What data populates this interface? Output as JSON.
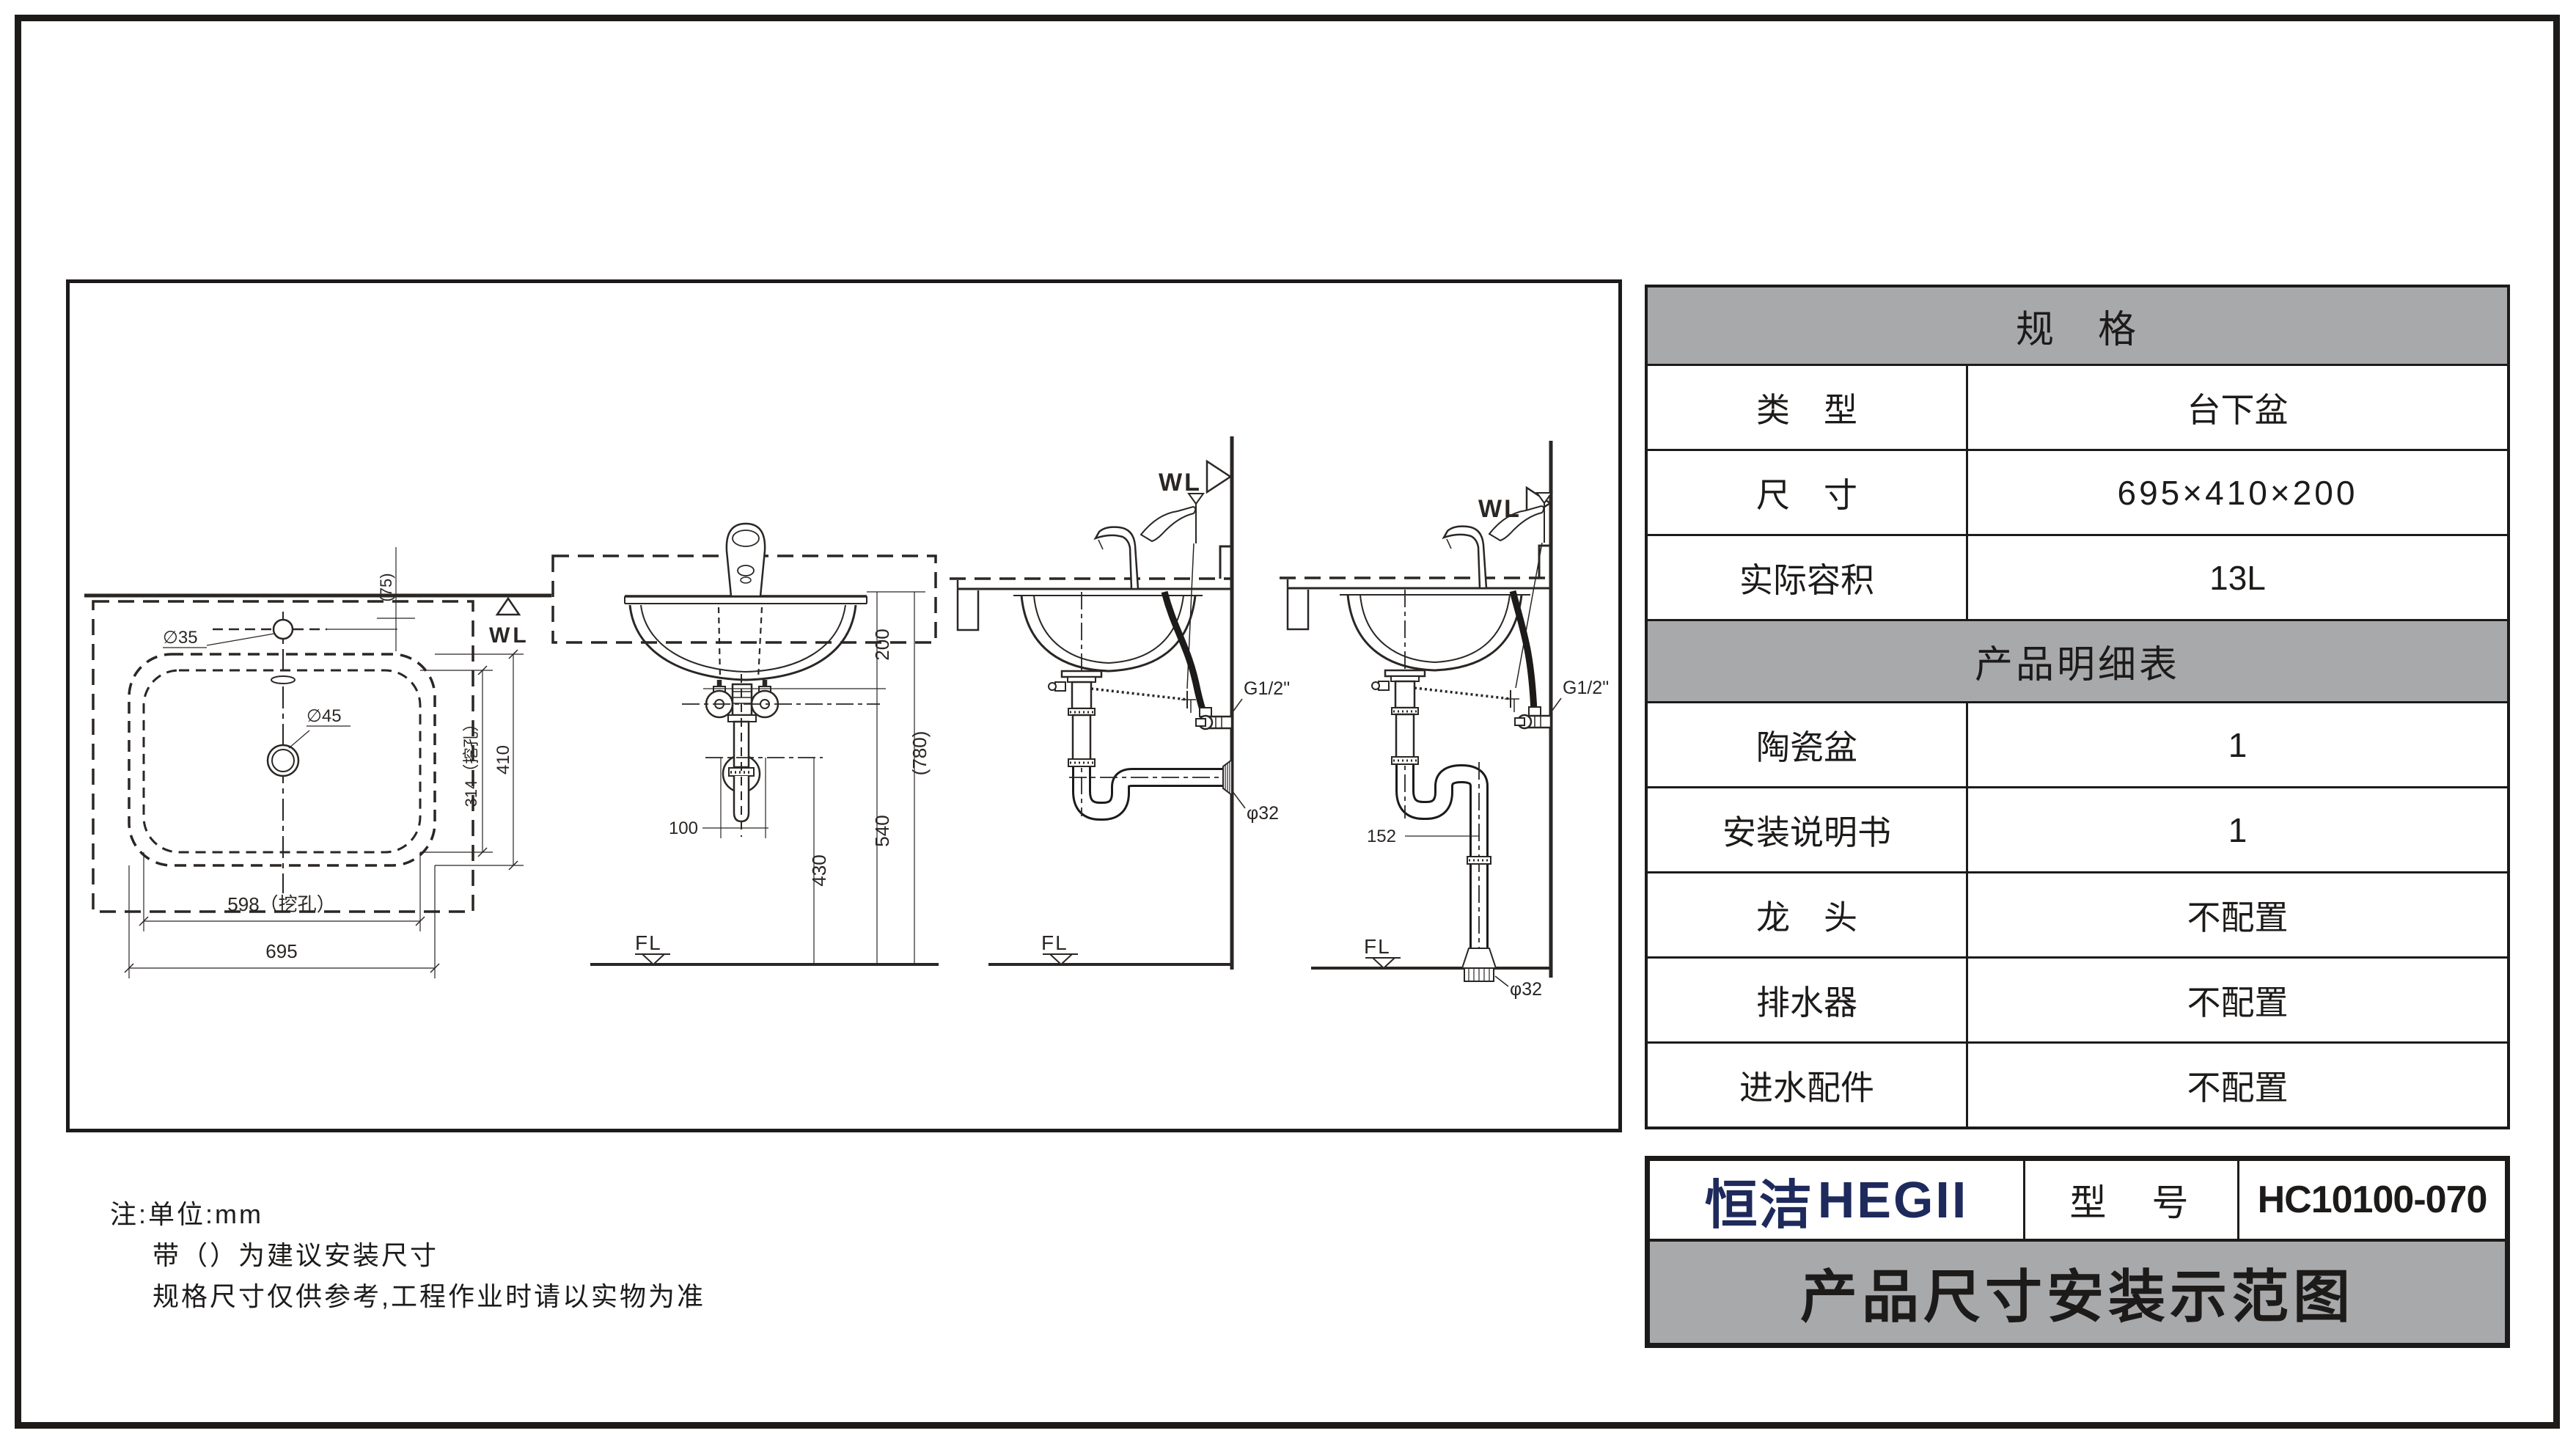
{
  "colors": {
    "line": "#2a2624",
    "frame": "#1d1b1a",
    "header_gray": "#a8a9ab",
    "brand_navy": "#1e2a5c",
    "background": "#ffffff"
  },
  "spec_table": {
    "header": "规　格",
    "rows": [
      {
        "label": "类　型",
        "value": "台下盆"
      },
      {
        "label": "尺　寸",
        "value": "695×410×200"
      },
      {
        "label": "实际容积",
        "value": "13L"
      }
    ],
    "subheader": "产品明细表",
    "detail_rows": [
      {
        "label": "陶瓷盆",
        "value": "1"
      },
      {
        "label": "安装说明书",
        "value": "1"
      },
      {
        "label": "龙　头",
        "value": "不配置"
      },
      {
        "label": "排水器",
        "value": "不配置"
      },
      {
        "label": "进水配件",
        "value": "不配置"
      }
    ]
  },
  "title_block": {
    "logo_cn": "恒洁",
    "logo_en": "HEGII",
    "model_label": "型　号",
    "model_value": "HC10100-070",
    "banner": "产品尺寸安装示范图"
  },
  "notes": {
    "line1": "注:单位:mm",
    "line2": "带（）为建议安装尺寸",
    "line3": "规格尺寸仅供参考,工程作业时请以实物为准"
  },
  "drawings": {
    "plan": {
      "wl": "WL",
      "dia35": "∅35",
      "dia45": "∅45",
      "dim_75": "(75)",
      "dim_314": "314（挖孔）",
      "dim_410": "410",
      "dim_598": "598（挖孔）",
      "dim_695": "695"
    },
    "front": {
      "dim_200": "200",
      "dim_780": "(780)",
      "dim_540": "540",
      "dim_430": "430",
      "dim_100": "100",
      "fl": "FL"
    },
    "side_wall": {
      "wl": "WL",
      "g": "G1/2\"",
      "phi": "φ32",
      "fl": "FL"
    },
    "side_floor": {
      "wl": "WL",
      "g": "G1/2\"",
      "phi": "φ32",
      "fl": "FL",
      "dim_152": "152"
    }
  }
}
